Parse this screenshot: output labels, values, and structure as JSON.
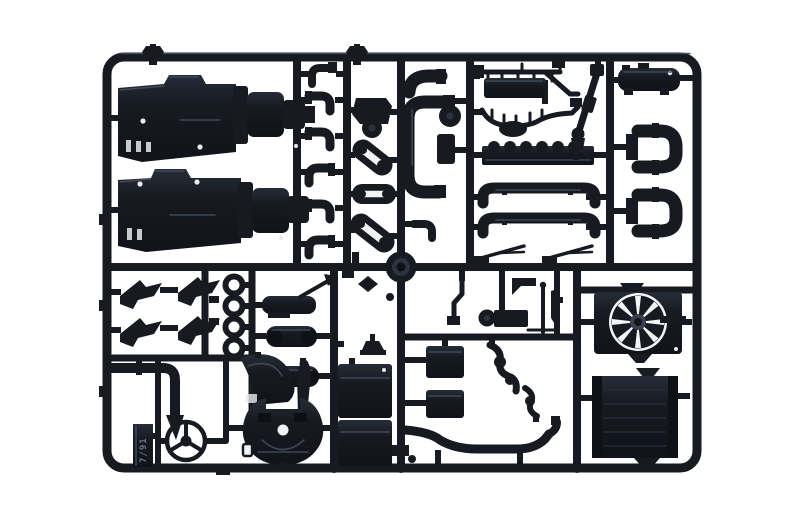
{
  "scene": {
    "type": "product-photo",
    "subject": "Injection-molded black plastic model kit sprue (runner frame) holding unassembled truck engine and chassis parts, photographed on a plain white background",
    "background": "plain white"
  },
  "colors": {
    "background": "#ffffff",
    "plastic": "#171a20",
    "plastic_light": "#2c333e",
    "highlight": "#444d5b",
    "mold_mark": "#6b7487"
  },
  "mold_tab": {
    "text": "7/91"
  },
  "parts": [
    {
      "name": "engine-block-half-upper"
    },
    {
      "name": "engine-block-half-lower"
    },
    {
      "name": "elbow-fittings-column"
    },
    {
      "name": "pulley-and-belt-parts"
    },
    {
      "name": "large-loop-pipe"
    },
    {
      "name": "injector-rail"
    },
    {
      "name": "wiring-loom-manifold"
    },
    {
      "name": "finned-cylinder-block"
    },
    {
      "name": "long-tube-upper"
    },
    {
      "name": "long-tube-lower"
    },
    {
      "name": "drive-shaft"
    },
    {
      "name": "valve-cover"
    },
    {
      "name": "exhaust-elbow-pair-upper"
    },
    {
      "name": "exhaust-elbow-pair-lower"
    },
    {
      "name": "center-sprue-hub"
    },
    {
      "name": "spring-bracket-set"
    },
    {
      "name": "sealing-rings"
    },
    {
      "name": "air-dryer"
    },
    {
      "name": "air-tank-1"
    },
    {
      "name": "air-tank-2"
    },
    {
      "name": "wiper-arm-1"
    },
    {
      "name": "wiper-arm-2"
    },
    {
      "name": "fan-with-shroud"
    },
    {
      "name": "radiator"
    },
    {
      "name": "l-shaped-pipe"
    },
    {
      "name": "fender-panel"
    },
    {
      "name": "gear-lever"
    },
    {
      "name": "steering-wheel"
    },
    {
      "name": "fifth-wheel-coupling"
    },
    {
      "name": "battery-box-1"
    },
    {
      "name": "battery-box-2"
    },
    {
      "name": "equipment-box-1"
    },
    {
      "name": "equipment-box-2"
    },
    {
      "name": "s-bend-hose-1"
    },
    {
      "name": "s-bend-hose-2"
    },
    {
      "name": "long-exhaust-pipe"
    },
    {
      "name": "antenna-rod"
    },
    {
      "name": "mold-code-tab"
    }
  ]
}
